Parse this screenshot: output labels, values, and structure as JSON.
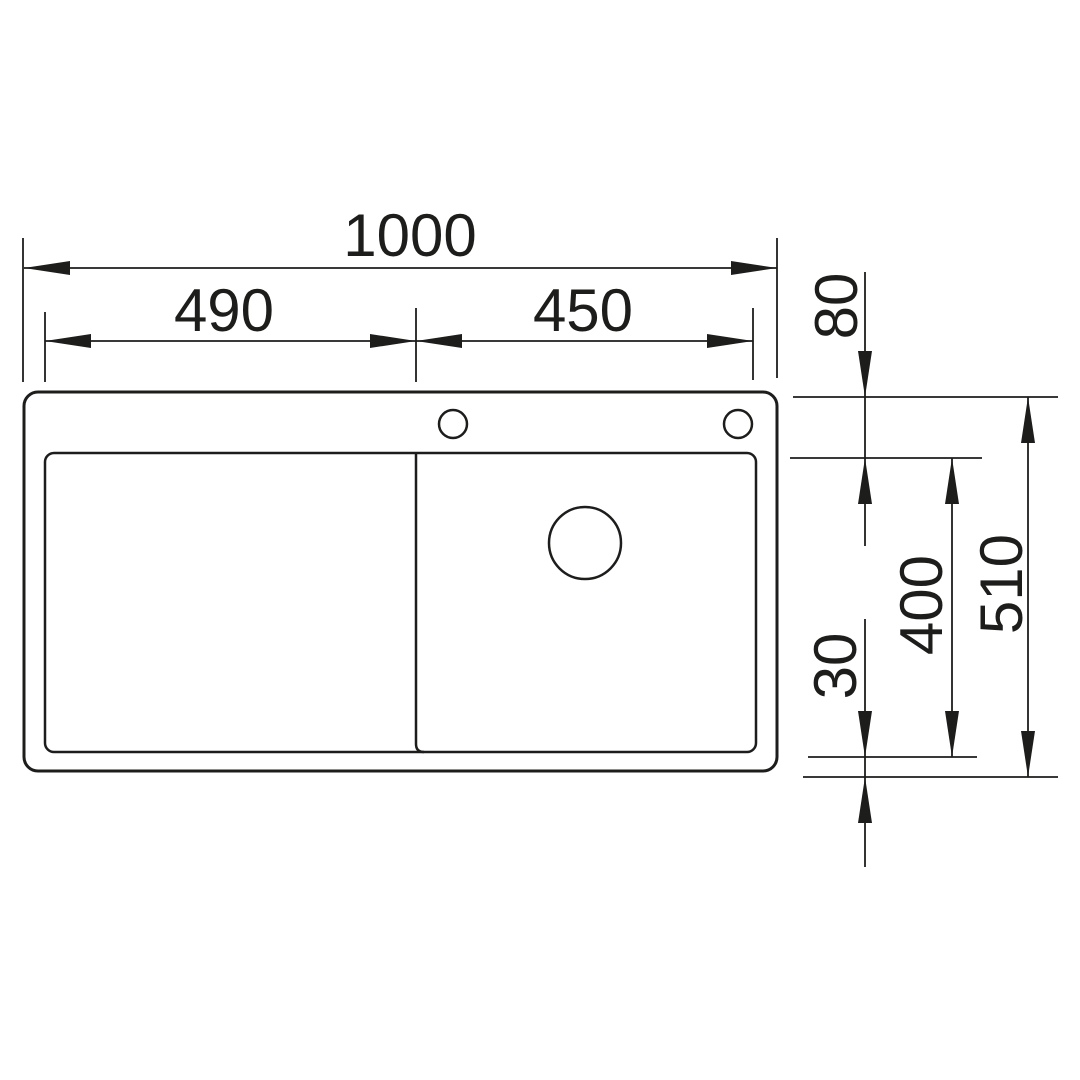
{
  "drawing": {
    "dimensions": {
      "overall_width": "1000",
      "left_section_width": "490",
      "right_section_width": "450",
      "top_rim": "80",
      "overall_depth": "510",
      "bowl_depth": "400",
      "bottom_rim": "30"
    },
    "colors": {
      "line": "#1d1d1b",
      "background": "#ffffff"
    }
  }
}
